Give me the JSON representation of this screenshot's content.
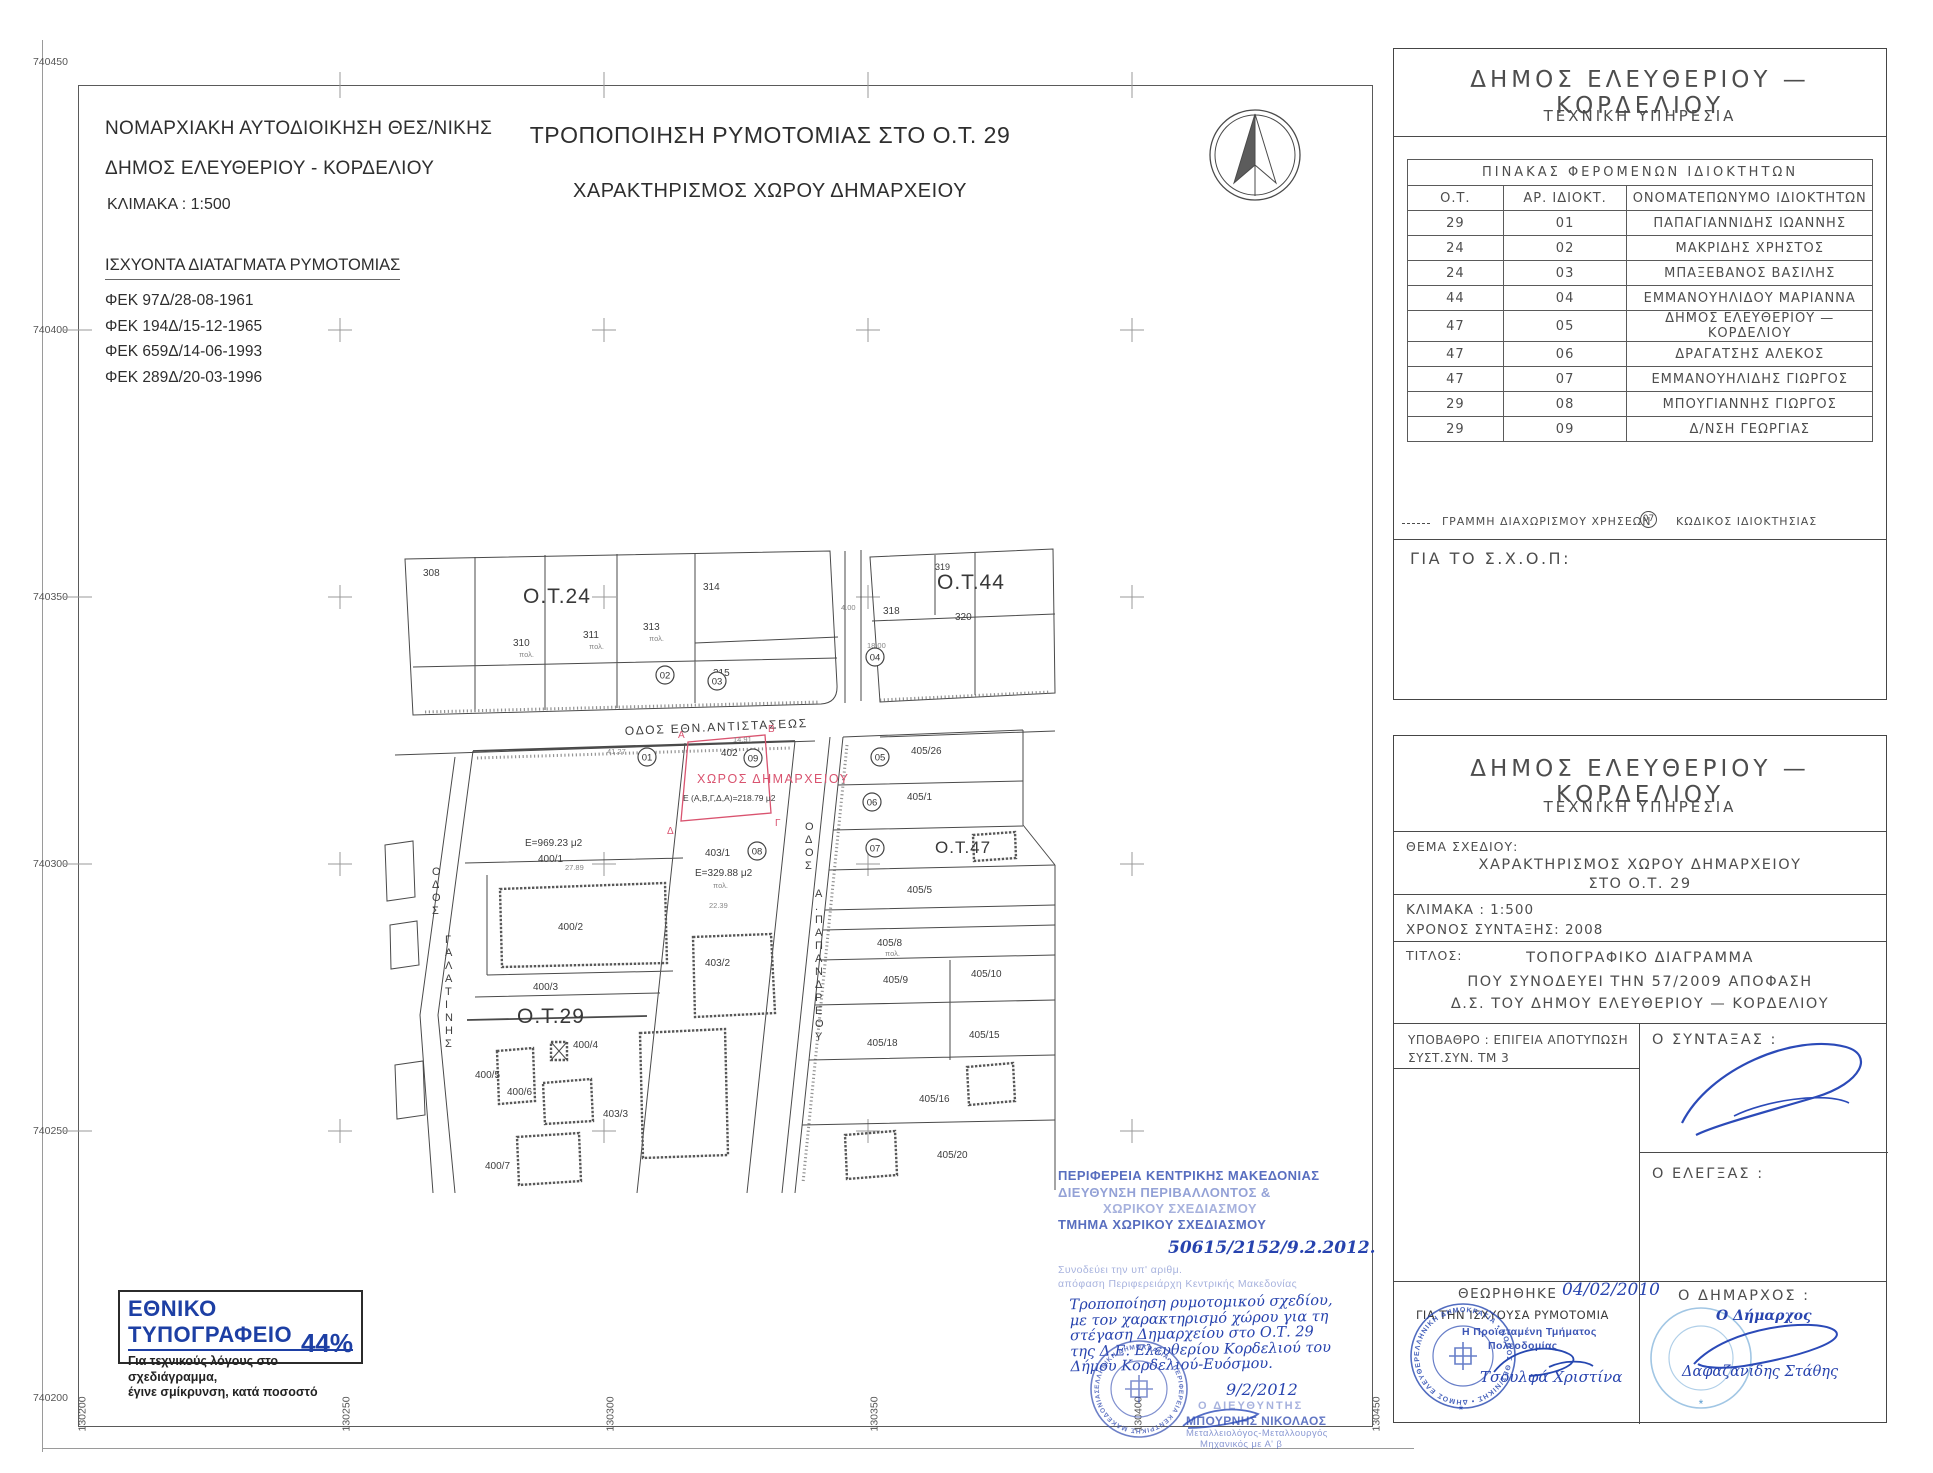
{
  "header_left": {
    "line1": "ΝΟΜΑΡΧΙΑΚΗ ΑΥΤΟΔΙΟΙΚΗΣΗ ΘΕΣ/ΝΙΚΗΣ",
    "line2": "ΔΗΜΟΣ ΕΛΕΥΘΕΡΙΟΥ - ΚΟΡΔΕΛΙΟΥ",
    "scale": "ΚΛΙΜΑΚΑ : 1:500"
  },
  "title": {
    "line1": "ΤΡΟΠΟΠΟΙΗΣΗ ΡΥΜΟΤΟΜΙΑΣ ΣΤΟ Ο.Τ. 29",
    "line2": "ΧΑΡΑΚΤΗΡΙΣΜΟΣ ΧΩΡΟΥ ΔΗΜΑΡΧΕΙΟΥ"
  },
  "decrees": {
    "heading": "ΙΣΧΥΟΝΤΑ ΔΙΑΤΑΓΜΑΤΑ ΡΥΜΟΤΟΜΙΑΣ",
    "items": [
      "ΦΕΚ 97Δ/28-08-1961",
      "ΦΕΚ 194Δ/15-12-1965",
      "ΦΕΚ 659Δ/14-06-1993",
      "ΦΕΚ 289Δ/20-03-1996"
    ]
  },
  "axes": {
    "left": [
      "740450",
      "740400",
      "740350",
      "740300",
      "740250",
      "740200"
    ],
    "bottom": [
      "130200",
      "130250",
      "130300",
      "130350",
      "130400",
      "130450"
    ]
  },
  "map": {
    "blocks": {
      "ot24": "Ο.Τ.24",
      "ot44": "Ο.Τ.44",
      "ot29": "Ο.Τ.29",
      "ot47": "Ο.Τ.47"
    },
    "streets": {
      "ethn": "ΟΔΟΣ ΕΘΝ.ΑΝΤΙΣΤΑΣΕΩΣ",
      "odos": "ΟΔΟΣ",
      "galatinis": "ΓΑΛΑΤΙΝΗΣ",
      "papandreou": "Α.ΠΑΠΑΝΔΡΕΟΥ"
    },
    "dimarcheio": {
      "label": "ΧΩΡΟΣ ΔΗΜΑΡΧΕΙΟΥ",
      "area": "Ε (Α,Β,Γ,Δ,Α)=218.79 μ2",
      "corner_a": "Α",
      "corner_b": "Β",
      "corner_g": "Γ",
      "corner_d": "Δ"
    },
    "areas": {
      "a400_1": "Ε=969.23 μ2",
      "a403_1": "Ε=329.88 μ2"
    },
    "parcels": {
      "p308": "308",
      "p310": "310",
      "p311": "311",
      "p313": "313",
      "p314": "314",
      "p315": "315",
      "p318": "318",
      "p319": "319",
      "p320": "320",
      "p400_1": "400/1",
      "p400_2": "400/2",
      "p400_3": "400/3",
      "p400_4": "400/4",
      "p400_5": "400/5",
      "p400_6": "400/6",
      "p400_7": "400/7",
      "p402": "402",
      "p403_1": "403/1",
      "p403_2": "403/2",
      "p403_3": "403/3",
      "p405_26": "405/26",
      "p405_1": "405/1",
      "p405_5": "405/5",
      "p405_8": "405/8",
      "p405_9": "405/9",
      "p405_10": "405/10",
      "p405_15": "405/15",
      "p405_18": "405/18",
      "p405_16": "405/16",
      "p405_20": "405/20"
    },
    "codes": {
      "c01": "01",
      "c02": "02",
      "c03": "03",
      "c04": "04",
      "c05": "05",
      "c06": "06",
      "c07": "07",
      "c08": "08",
      "c09": "09"
    },
    "dims": {
      "d1": "41.27",
      "d2": "14.91",
      "d3": "27.89",
      "d4": "22.39",
      "d5": "18.00",
      "d6": "4.00"
    },
    "pol": "πολ."
  },
  "owners_panel": {
    "org": "ΔΗΜΟΣ ΕΛΕΥΘΕΡΙΟΥ — ΚΟΡΔΕΛΙΟΥ",
    "dept": "ΤΕΧΝΙΚΗ ΥΠΗΡΕΣΙΑ",
    "table_title": "ΠΙΝΑΚΑΣ ΦΕΡΟΜΕΝΩΝ ΙΔΙΟΚΤΗΤΩΝ",
    "col_ot": "Ο.Τ.",
    "col_ar": "ΑΡ. ΙΔΙΟΚΤ.",
    "col_name": "ΟΝΟΜΑΤΕΠΩΝΥΜΟ ΙΔΙΟΚΤΗΤΩΝ",
    "rows": [
      [
        "29",
        "01",
        "ΠΑΠΑΓΙΑΝΝΙΔΗΣ ΙΩΑΝΝΗΣ"
      ],
      [
        "24",
        "02",
        "ΜΑΚΡΙΔΗΣ ΧΡΗΣΤΟΣ"
      ],
      [
        "24",
        "03",
        "ΜΠΑΞΕΒΑΝΟΣ ΒΑΣΙΛΗΣ"
      ],
      [
        "44",
        "04",
        "ΕΜΜΑΝΟΥΗΛΙΔΟΥ ΜΑΡΙΑΝΝΑ"
      ],
      [
        "47",
        "05",
        "ΔΗΜΟΣ ΕΛΕΥΘΕΡΙΟΥ — ΚΟΡΔΕΛΙΟΥ"
      ],
      [
        "47",
        "06",
        "ΔΡΑΓΑΤΣΗΣ ΑΛΕΚΟΣ"
      ],
      [
        "47",
        "07",
        "ΕΜΜΑΝΟΥΗΛΙΔΗΣ ΓΙΩΡΓΟΣ"
      ],
      [
        "29",
        "08",
        "ΜΠΟΥΓΙΑΝΝΗΣ ΓΙΩΡΓΟΣ"
      ],
      [
        "29",
        "09",
        "Δ/ΝΣΗ ΓΕΩΡΓΙΑΣ"
      ]
    ],
    "legend_line": "ΓΡΑΜΜΗ ΔΙΑΧΩΡΙΣΜΟΥ ΧΡΗΣΕΩΝ",
    "legend_code_symbol": "07",
    "legend_code": "ΚΩΔΙΚΟΣ ΙΔΙΟΚΤΗΣΙΑΣ",
    "for_schop": "ΓΙΑ ΤΟ Σ.Χ.Ο.Π:"
  },
  "title_block": {
    "org": "ΔΗΜΟΣ ΕΛΕΥΘΕΡΙΟΥ — ΚΟΡΔΕΛΙΟΥ",
    "dept": "ΤΕΧΝΙΚΗ ΥΠΗΡΕΣΙΑ",
    "thema_label": "ΘΕΜΑ ΣΧΕΔΙΟΥ:",
    "thema1": "ΧΑΡΑΚΤΗΡΙΣΜΟΣ ΧΩΡΟΥ ΔΗΜΑΡΧΕΙΟΥ",
    "thema2": "ΣΤΟ Ο.Τ. 29",
    "scale": "ΚΛΙΜΑΚΑ : 1:500",
    "year": "ΧΡΟΝΟΣ ΣΥΝΤΑΞΗΣ: 2008",
    "titlos_label": "ΤΙΤΛΟΣ:",
    "titlos1": "ΤΟΠΟΓΡΑΦΙΚΟ ΔΙΑΓΡΑΜΜΑ",
    "titlos2": "ΠΟΥ ΣΥΝΟΔΕΥΕΙ ΤΗΝ 57/2009 ΑΠΟΦΑΣΗ",
    "titlos3": "Δ.Σ. ΤΟΥ ΔΗΜΟΥ ΕΛΕΥΘΕΡΙΟΥ — ΚΟΡΔΕΛΙΟΥ",
    "ypovathro": "ΥΠΟΒΑΘΡΟ : ΕΠΙΓΕΙΑ ΑΠΟΤΥΠΩΣΗ",
    "syst": "ΣΥΣΤ.ΣΥΝ. ΤΜ 3",
    "syntaxas": "Ο ΣΥΝΤΑΞΑΣ :",
    "elegxas": "Ο ΕΛΕΓΞΑΣ :",
    "theorithike": "ΘΕΩΡΗΘΗΚΕ",
    "theorithike_date": "04/02/2010",
    "gia_tin": "ΓΙΑ ΤΗΝ ΙΣΧΥΟΥΣΑ ΡΥΜΟΤΟΜΙΑ",
    "proist1": "Η Προϊσταμένη Τμήματος",
    "proist2": "Πολεοδομίας",
    "proist_name": "Τσουλφά Χριστίνα",
    "dimarxos_label": "Ο ΔΗΜΑΡΧΟΣ :",
    "dimarxos_hand": "Ο Δήμαρχος",
    "dimarxos_name": "Δαφαζανίδης Στάθης"
  },
  "region_stamp": {
    "line1": "ΠΕΡΙΦΕΡΕΙΑ ΚΕΝΤΡΙΚΗΣ ΜΑΚΕΔΟΝΙΑΣ",
    "line2": "ΔΙΕΥΘΥΝΣΗ ΠΕΡΙΒΑΛΛΟΝΤΟΣ &",
    "line3": "ΧΩΡΙΚΟΥ ΣΧΕΔΙΑΣΜΟΥ",
    "line4": "ΤΜΗΜΑ ΧΩΡΙΚΟΥ ΣΧΕΔΙΑΣΜΟΥ",
    "protocol": "50615/2152/9.2.2012.",
    "faint1": "Συνοδεύει την υπ' αριθμ.",
    "faint2": "απόφαση Περιφερειάρχη Κεντρικής Μακεδονίας",
    "hand1": "Τροποποίηση ρυμοτομικού σχεδίου,",
    "hand2": "με τον χαρακτηρισμό χώρου για τη",
    "hand3": "στέγαση Δημαρχείου στο Ο.Τ. 29",
    "hand4": "της Δ.Ε. Ελευθερίου Κορδελιού του",
    "hand5": "Δήμου Κορδελιού-Ευόσμου.",
    "date": "9/2/2012",
    "director_title": "Ο ΔΙΕΥΘΥΝΤΗΣ",
    "director_name": "ΜΠΟΥΡΝΗΣ ΝΙΚΟΛΑΟΣ",
    "director_cred1": "Μεταλλειολόγος-Μεταλλουργός",
    "director_cred2": "Μηχανικός με Α' β"
  },
  "printing_office": {
    "title": "ΕΘΝΙΚΟ ΤΥΠΟΓΡΑΦΕΙΟ",
    "line1": "Για τεχνικούς λόγους στο σχεδιάγραμμα,",
    "line2": "έγινε σμίκρυνση, κατά ποσοστό",
    "percent": "44%"
  },
  "stamps": {
    "blue_ring": "ΕΛΛΗΝΙΚΗ ΔΗΜΟΚΡΑΤΙΑ • ΝΟΜΟΣ ΘΕΣ/ΝΙΚΗΣ • ΔΗΜΟΣ ΕΛΕΥΘΕΡΙΟΥ",
    "region_ring": "ΕΛΛΗΝΙΚΗ ΔΗΜΟΚΡΑΤΙΑ • ΠΕΡΙΦΕΡΕΙΑ ΚΕΝΤΡΙΚΗΣ ΜΑΚΕΔΟΝΙΑΣ",
    "star": "*"
  }
}
